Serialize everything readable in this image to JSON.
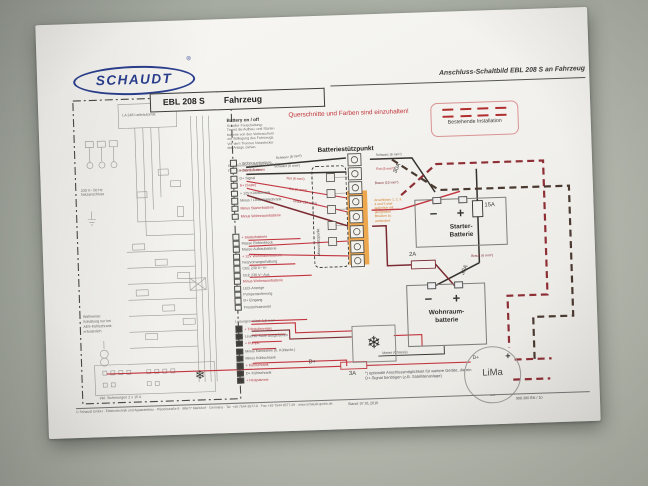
{
  "header": {
    "logo": "SCHAUDT",
    "registered": "®",
    "doc_title": "Anschluss-Schaltbild EBL 208 S an Fahrzeug",
    "unit_label": "EBL 208 S",
    "vehicle_label": "Fahrzeug"
  },
  "notices": {
    "cross": "Querschnitte und Farben sind einzuhalten!",
    "legend": "Bestehende Installation"
  },
  "battery": {
    "support_point": "Batteriestützpunkt",
    "minus_point": "Minusstützpunkt",
    "orange_note": "Anschlüsse 1, 2, 3, 4 und 5 sind äußerlich mit geeigneten Brücken zu verbinden!",
    "starter1": "Starter-",
    "starter2": "Batterie",
    "living1": "Wohnraum-",
    "living2": "batterie",
    "minus_sign": "−",
    "plus_sign": "+"
  },
  "fuses": {
    "f1": "30A",
    "f2": "15A",
    "f3": "2A",
    "f4": "30A",
    "f5": "3A"
  },
  "lima": {
    "label": "LiMa",
    "dplus": "D+",
    "plus": "+",
    "minus": "−"
  },
  "dplus": {
    "label": "D+",
    "footnote": "*) optionale Anschlussmöglichkeit für weitere Geräte, die ein D+-Signal benötigen (z.B. Satellitenanlage)"
  },
  "info": {
    "title": "Battery on / off",
    "lines": [
      "Schalter Freischaltung:",
      "Trennt die Aufbau- und Starter-",
      "batterie von den Verbrauchern",
      "zur Stilllegung des Fahrzeugs.",
      "Vor dem Trennen Netzstecker",
      "der Anlage ziehen."
    ]
  },
  "klem": [
    "Klemmenbezeichnung 17-26 AV:",
    "Flachstecker 6,3 mm"
  ],
  "wire_labels": [
    "Schwarz (6 mm²)",
    "Schwarz (6 mm²)",
    "Rot (6 mm²)",
    "Rot (6 mm²)",
    "Braun (10 mm²)",
    "Braun (6 mm²)",
    "Masse (Chassis)"
  ],
  "terminals": {
    "b1": [
      "+ Wohnraumbatterie",
      "+ Starterbatterie",
      "D+ Signal",
      "S+ (Solar)",
      "+ 12V Kühlschrank",
      "Minus / LiMa Kühlschrank",
      "Minus Starterbatterie",
      "Minus Wohnraumbatterie"
    ],
    "b2": [
      "+ Starterbatterie",
      "Masse Elektroblock",
      "Masse Aufbaubatterie",
      "+ 12V Wohnraumbatterie",
      "Netzvorrangschaltung",
      "CEE 230 V~ In",
      "CEE 230 V~ Aus",
      "Minus Wohnraumbatterie",
      "LED-Anzeige",
      "Pumpensicherung",
      "D+ Eingang",
      "Frostschutzventil"
    ],
    "b3": [
      "+ Trittstufenrelais",
      "Leuchte Stufe ausgefahren",
      "+ Pumpe",
      "Minus Karosserie (b. Kühlschr.)",
      "Minus Kühlschrank",
      "+ Kühlschrank",
      "D+ Kühlschrank",
      "+ Heizpatrone"
    ]
  },
  "left": {
    "la": "LA 248 Ladeautomat",
    "mains": "230 V~ 50 Hz Netzanschluss",
    "note": [
      "Wahlweise:",
      "Schaltung nur bei",
      "AES-Kühlschrank",
      "erforderlich"
    ],
    "bottom_note": "inkl. Sicherungen 2 x 15 A",
    "modus": "Leitungen mind. 1,5 mm²"
  },
  "footer": {
    "copy": "© Schaudt GmbH · Elektrotechnik und Apparatebau · Planckstraße 8 · 88677 Markdorf · Germany · Tel. +49 7544 9577-0 · Fax +49 7544 9577-29 · www.schaudt-gmbh.de",
    "date": "Stand: 07.01.2010",
    "doc": "908.380 BN / 10"
  },
  "colors": {
    "schaudt_blue": "#2b3f8f",
    "notice_red": "#c2333a",
    "existing_dashed_red": "#8e2f36",
    "existing_dashed_dark": "#4b3a31",
    "wire_black": "#35322e",
    "wire_red": "#c2343f",
    "wire_brown": "#7c2b33",
    "orange_highlight": "#ec9a33"
  }
}
